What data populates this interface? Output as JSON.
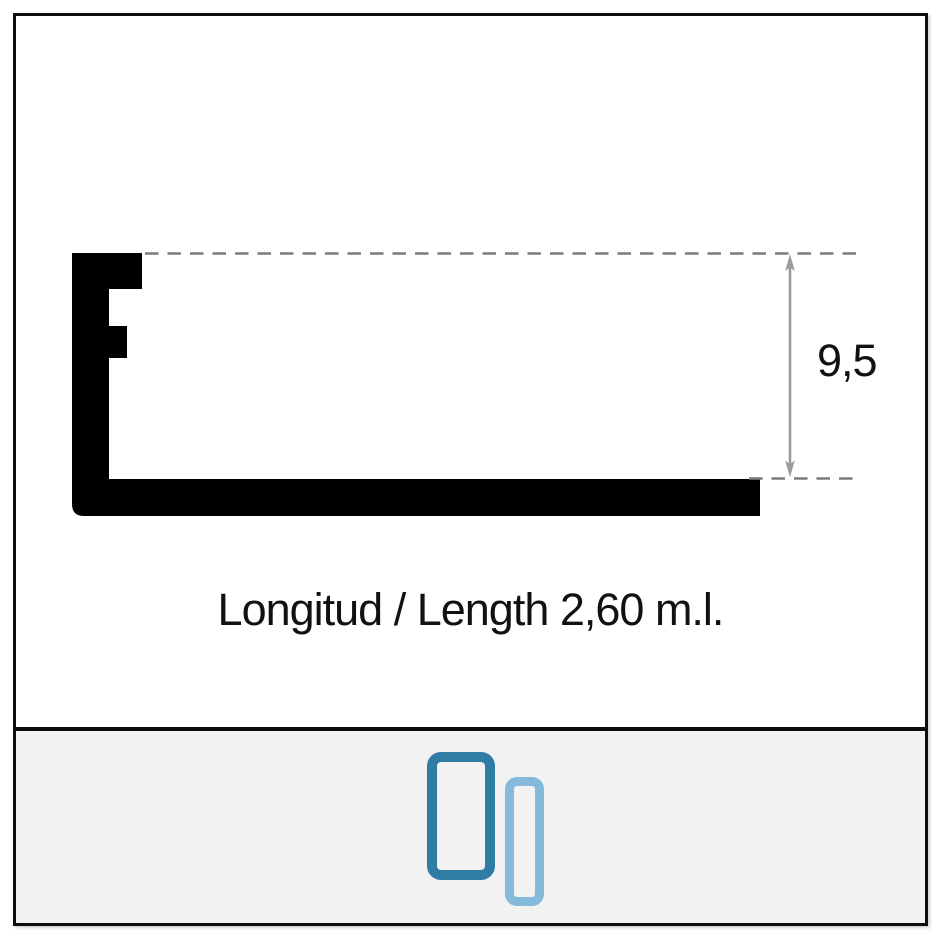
{
  "diagram": {
    "dimension_value": "9,5",
    "length_caption": "Longitud / Length 2,60 m.l."
  },
  "footer": {
    "icons": [
      {
        "name": "profile-thumbnail-large",
        "color": "#2f7ca4"
      },
      {
        "name": "profile-thumbnail-small",
        "color": "#85badb"
      }
    ]
  },
  "colors": {
    "frame_border": "#0d0d0d",
    "profile_fill": "#000000",
    "dash_line": "#7b7b7b",
    "dimension_arrow": "#9c9c9c",
    "text": "#111111",
    "footer_background": "#f2f2f3"
  }
}
